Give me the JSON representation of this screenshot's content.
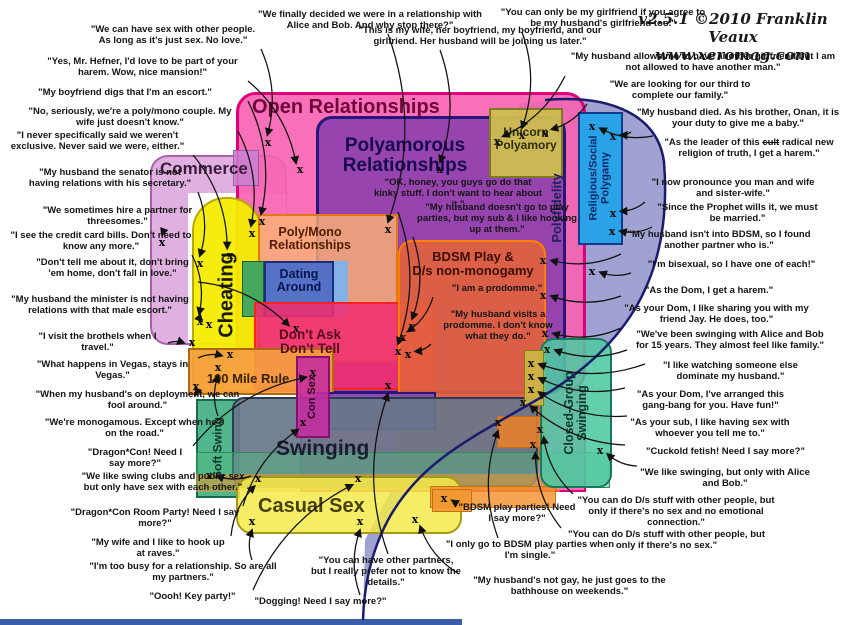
{
  "attribution": {
    "version": "v2.5.1 ©2010 Franklin Veaux",
    "site": "www.xeromag.com"
  },
  "diagram": {
    "blob": {
      "id": "polyfidelity-blob",
      "fill": "rgba(150,153,204,0.9)",
      "stroke": "#1c1c6e"
    },
    "regions": [
      {
        "id": "commerce",
        "x": 150,
        "y": 155,
        "w": 137,
        "h": 190,
        "fill": "rgba(221,170,221,0.92)",
        "stroke": "#a860a8",
        "bw": 2,
        "r": 18,
        "label": "Commerce",
        "lx": 160,
        "ly": 160,
        "fs": 17,
        "lc": "#3a1a3a"
      },
      {
        "id": "commerce-inner",
        "x": 188,
        "y": 193,
        "w": 98,
        "h": 150,
        "fill": "#ffffff"
      },
      {
        "id": "open-relationships",
        "x": 236,
        "y": 92,
        "w": 350,
        "h": 300,
        "fill": "rgba(247,98,176,0.9)",
        "stroke": "#e0007a",
        "bw": 3,
        "r": 20,
        "label": "Open Relationships",
        "lx": 252,
        "ly": 97,
        "fs": 20,
        "lc": "#70043c"
      },
      {
        "id": "open-relationships-lower",
        "x": 300,
        "y": 388,
        "w": 286,
        "h": 104,
        "fill": "rgba(247,98,176,0.9)",
        "stroke": "#e0007a",
        "bw": 2
      },
      {
        "id": "cheating",
        "x": 192,
        "y": 197,
        "w": 70,
        "h": 196,
        "fill": "rgba(244,236,0,0.95)",
        "stroke": "#b8a800",
        "bw": 2,
        "r": "34px 34px 10px 10px",
        "label": "Cheating",
        "vert": true,
        "lx": 227,
        "ly": 295,
        "fs": 20,
        "lc": "#1a1a00"
      },
      {
        "id": "polyamorous-relationships",
        "x": 316,
        "y": 116,
        "w": 250,
        "h": 278,
        "fill": "rgba(138,62,172,0.88)",
        "stroke": "#281578",
        "bw": 3,
        "r": 16,
        "label": "Polyamorous\nRelationships",
        "lx": 325,
        "ly": 136,
        "labelW": 160,
        "fs": 19,
        "lc": "#160a50"
      },
      {
        "id": "unicorn-polyamory",
        "x": 489,
        "y": 108,
        "w": 74,
        "h": 70,
        "fill": "rgba(205,190,80,0.95)",
        "stroke": "#7a7a20",
        "bw": 2,
        "label": "Unicorn\nPolyamory",
        "lx": 489,
        "ly": 126,
        "labelW": 74,
        "fs": 12,
        "lc": "#2e2e08"
      },
      {
        "id": "religious-social-polygamy",
        "x": 578,
        "y": 112,
        "w": 45,
        "h": 133,
        "fill": "#2aa2e8",
        "stroke": "#123a8c",
        "bw": 2,
        "label": "Religious/Social\nPolygamy",
        "vert": true,
        "lx": 600,
        "ly": 178,
        "fs": 11,
        "lc": "#0a2a6a"
      },
      {
        "id": "polyfidelity-label-anchor",
        "x": 0,
        "y": 0,
        "w": 0,
        "h": 0,
        "fill": "transparent",
        "label": "Polyfidelity",
        "vert": true,
        "lx": 557,
        "ly": 208,
        "fs": 13,
        "lc": "#20205a"
      },
      {
        "id": "poly-mono-relationships",
        "x": 258,
        "y": 214,
        "w": 140,
        "h": 148,
        "fill": "rgba(250,178,116,0.82)",
        "stroke": "#e07818",
        "bw": 2,
        "label": "Poly/Mono\nRelationships",
        "lx": 262,
        "ly": 226,
        "labelW": 96,
        "fs": 12.5,
        "lc": "#501c00"
      },
      {
        "id": "dating-around-green",
        "x": 242,
        "y": 261,
        "w": 22,
        "h": 56,
        "fill": "#46a85c",
        "stroke": "#1c5c2c",
        "bw": 1.5
      },
      {
        "id": "dating-around",
        "x": 264,
        "y": 261,
        "w": 70,
        "h": 56,
        "fill": "rgba(70,110,205,0.92)",
        "stroke": "#1c2c80",
        "bw": 2,
        "label": "Dating\nAround",
        "lx": 264,
        "ly": 268,
        "labelW": 70,
        "fs": 12.5,
        "lc": "#0a1650"
      },
      {
        "id": "dating-around-lightblue",
        "x": 334,
        "y": 261,
        "w": 14,
        "h": 56,
        "fill": "rgba(120,180,240,0.9)"
      },
      {
        "id": "dont-ask-dont-tell",
        "x": 254,
        "y": 302,
        "w": 180,
        "h": 88,
        "fill": "rgba(240,45,110,0.88)",
        "stroke": "#ff2020",
        "bw": 2.5,
        "label": "Don't Ask\nDon't Tell",
        "lx": 262,
        "ly": 328,
        "labelW": 96,
        "fs": 13.5,
        "lc": "#58081e"
      },
      {
        "id": "hundred-mile-rule",
        "x": 188,
        "y": 348,
        "w": 146,
        "h": 47,
        "fill": "rgba(245,158,64,0.92)",
        "stroke": "#b06810",
        "bw": 2,
        "label": "100 Mile Rule",
        "lx": 196,
        "ly": 372,
        "labelW": 104,
        "fs": 13,
        "lc": "#3a2000"
      },
      {
        "id": "escort-overlap",
        "x": 233,
        "y": 150,
        "w": 26,
        "h": 36,
        "fill": "rgba(200,130,210,0.85)",
        "stroke": "#9a5aaa",
        "bw": 1.5
      },
      {
        "id": "bdsm-ds-nonmonogamy",
        "x": 398,
        "y": 240,
        "w": 148,
        "h": 226,
        "fill": "rgba(226,99,60,0.9)",
        "stroke": "#ff8000",
        "bw": 2.5,
        "r": 14,
        "label": "BDSM Play &\nD/s non-monogamy",
        "lx": 404,
        "ly": 250,
        "labelW": 138,
        "fs": 13,
        "lc": "#3c0e00"
      },
      {
        "id": "poly-swing-overlap",
        "x": 316,
        "y": 392,
        "w": 120,
        "h": 38,
        "fill": "rgba(110,70,180,0.8)",
        "stroke": "#281578",
        "bw": 2
      },
      {
        "id": "soft-swing",
        "x": 196,
        "y": 399,
        "w": 44,
        "h": 99,
        "fill": "rgba(72,178,136,0.95)",
        "stroke": "#1a6a4a",
        "bw": 2,
        "label": "Soft Swing",
        "vert": true,
        "lx": 218,
        "ly": 448,
        "fs": 12,
        "lc": "#0c3626"
      },
      {
        "id": "swinging",
        "x": 232,
        "y": 397,
        "w": 306,
        "h": 90,
        "fill": "rgba(104,118,138,0.92)",
        "stroke": "#2c3a52",
        "bw": 2,
        "r": 12,
        "label": "Swinging",
        "lx": 276,
        "ly": 438,
        "fs": 21,
        "lc": "#141e2e"
      },
      {
        "id": "con-sex",
        "x": 296,
        "y": 356,
        "w": 34,
        "h": 82,
        "fill": "rgba(198,44,160,0.88)",
        "stroke": "#86106e",
        "bw": 2,
        "label": "Con Sex",
        "vert": true,
        "lx": 313,
        "ly": 397,
        "fs": 11,
        "lc": "#2e0026"
      },
      {
        "id": "swing-green-band",
        "x": 196,
        "y": 452,
        "w": 414,
        "h": 36,
        "fill": "rgba(80,185,125,0.45)",
        "stroke": "#2e8b57",
        "bw": 1.5
      },
      {
        "id": "orange-band",
        "x": 196,
        "y": 474,
        "w": 364,
        "h": 18,
        "fill": "rgba(242,152,50,0.55)"
      },
      {
        "id": "casual-sex",
        "x": 236,
        "y": 476,
        "w": 226,
        "h": 58,
        "fill": "rgba(242,234,74,0.85)",
        "stroke": "#a89a18",
        "bw": 2,
        "r": 16,
        "label": "Casual Sex",
        "lx": 258,
        "ly": 496,
        "fs": 20,
        "lc": "#46400a"
      },
      {
        "id": "bdsm-party-box",
        "x": 497,
        "y": 416,
        "w": 46,
        "h": 32,
        "fill": "rgba(235,130,40,0.85)",
        "stroke": "#c87010",
        "bw": 1.5
      },
      {
        "id": "orange-band-2",
        "x": 430,
        "y": 486,
        "w": 126,
        "h": 22,
        "fill": "rgba(242,142,40,0.8)",
        "stroke": "#c87818",
        "bw": 1.5
      },
      {
        "id": "orange-box-2",
        "x": 432,
        "y": 489,
        "w": 40,
        "h": 23,
        "fill": "rgba(242,152,50,0.9)",
        "stroke": "#c87010",
        "bw": 1.5
      },
      {
        "id": "closed-group-swinging",
        "x": 540,
        "y": 338,
        "w": 72,
        "h": 150,
        "fill": "rgba(78,200,162,0.88)",
        "stroke": "#17785c",
        "bw": 2.5,
        "r": 14,
        "label": "Closed-Group\nSwinging",
        "vert": true,
        "lx": 576,
        "ly": 413,
        "fs": 12.5,
        "lc": "#0a3828"
      },
      {
        "id": "khaki-strip",
        "x": 524,
        "y": 350,
        "w": 20,
        "h": 56,
        "fill": "rgba(205,185,70,0.9)",
        "stroke": "#8a7a10",
        "bw": 1
      },
      {
        "id": "bottom-strip",
        "x": 0,
        "y": 619,
        "w": 462,
        "h": 6,
        "fill": "#3a5da8"
      }
    ]
  },
  "quotes": [
    {
      "id": "q01",
      "t": "\"We can have sex with other people. As long as it's just sex. No love.\"",
      "x": 88,
      "y": 25,
      "w": 170,
      "tx": 268,
      "ty": 143
    },
    {
      "id": "q02",
      "t": "\"Yes, Mr. Hefner, I'd love to be part of your harem. Wow, nice mansion!\"",
      "x": 40,
      "y": 57,
      "w": 205,
      "tx": 300,
      "ty": 170
    },
    {
      "id": "q03",
      "t": "\"My boyfriend digs that I'm an escort.\"",
      "x": 5,
      "y": 88,
      "w": 240,
      "tx": 262,
      "ty": 222
    },
    {
      "id": "q04",
      "t": "\"No, seriously, we're a poly/mono couple. My wife just doesn't know.\"",
      "x": 25,
      "y": 107,
      "w": 210,
      "tx": 252,
      "ty": 234
    },
    {
      "id": "q05",
      "t": "\"I never specifically said we weren't exclusive. Never said we were, either.\"",
      "x": 5,
      "y": 131,
      "w": 185,
      "tx": 230,
      "ty": 256
    },
    {
      "id": "q06",
      "t": "\"My husband the senator is not having relations with his secretary.\"",
      "x": 25,
      "y": 168,
      "w": 170,
      "tx": 200,
      "ty": 264
    },
    {
      "id": "q07",
      "t": "\"We sometimes hire a partner for threesomes.\"",
      "x": 25,
      "y": 206,
      "w": 185,
      "tx": 162,
      "ty": 243
    },
    {
      "id": "q08",
      "t": "\"I see the credit card bills. Don't need to know any more.\"",
      "x": 2,
      "y": 231,
      "w": 198,
      "tx": 200,
      "ty": 322
    },
    {
      "id": "q09",
      "t": "\"Don't tell me about it, don't bring 'em home, don't fall in love.\"",
      "x": 30,
      "y": 258,
      "w": 165,
      "tx": 296,
      "ty": 329
    },
    {
      "id": "q10",
      "t": "\"My husband the minister is not having relations with that male escort.\"",
      "x": 5,
      "y": 295,
      "w": 190,
      "tx": 209,
      "ty": 325
    },
    {
      "id": "q11",
      "t": "\"I visit the brothels when I travel.\"",
      "x": 30,
      "y": 332,
      "w": 135,
      "tx": 192,
      "ty": 343
    },
    {
      "id": "q12",
      "t": "\"What happens in Vegas, stays in Vegas.\"",
      "x": 30,
      "y": 360,
      "w": 165,
      "tx": 230,
      "ty": 355
    },
    {
      "id": "q13",
      "t": "\"When my husband's on deployment, we can fool around.\"",
      "x": 35,
      "y": 390,
      "w": 205,
      "tx": 196,
      "ty": 387
    },
    {
      "id": "q14",
      "t": "\"We're monogamous. Except when he's on the road.\"",
      "x": 42,
      "y": 418,
      "w": 185,
      "tx": 218,
      "ty": 368
    },
    {
      "id": "q15",
      "t": "\"Dragon*Con! Need I say more?\"",
      "x": 80,
      "y": 448,
      "w": 110,
      "tx": 313,
      "ty": 373
    },
    {
      "id": "q16",
      "t": "\"We like swing clubs and public sex but only have sex with each other.\"",
      "x": 78,
      "y": 472,
      "w": 170,
      "tx": 209,
      "ty": 476
    },
    {
      "id": "q17",
      "t": "\"Dragon*Con Room Party! Need I say more?\"",
      "x": 70,
      "y": 508,
      "w": 170,
      "tx": 303,
      "ty": 423
    },
    {
      "id": "q18",
      "t": "\"My wife and I like to hook up at raves.\"",
      "x": 88,
      "y": 538,
      "w": 140,
      "tx": 258,
      "ty": 479
    },
    {
      "id": "q19",
      "t": "\"I'm too busy for a relationship. So are all my partners.\"",
      "x": 88,
      "y": 562,
      "w": 190,
      "tx": 252,
      "ty": 522
    },
    {
      "id": "q20",
      "t": "\"Oooh! Key party!\"",
      "x": 135,
      "y": 592,
      "w": 115,
      "tx": 358,
      "ty": 479
    },
    {
      "id": "q21",
      "t": "\"Dogging! Need I say more?\"",
      "x": 238,
      "y": 597,
      "w": 165,
      "tx": 360,
      "ty": 522
    },
    {
      "id": "q22",
      "t": "\"We finally decided we were in a relationship with Alice and Bob. And why stop there?\"",
      "x": 255,
      "y": 10,
      "w": 230,
      "tx": 388,
      "ty": 230
    },
    {
      "id": "q23",
      "t": "\"This is my wife, her boyfriend, my boyfriend, and our girlfriend. Her husband will be joining us later.\"",
      "x": 350,
      "y": 26,
      "w": 260,
      "tx": 440,
      "ty": 170
    },
    {
      "id": "q24",
      "t": "\"You can only be my girlfriend if you agree to be my husband's girlfriend too.\"",
      "x": 498,
      "y": 8,
      "w": 210,
      "tx": 522,
      "ty": 136
    },
    {
      "id": "q25",
      "t": "\"My husband allows me to have another girlfriend but I am not allowed to have another man.\"",
      "x": 568,
      "y": 52,
      "w": 270,
      "tx": 497,
      "ty": 142
    },
    {
      "id": "q26",
      "t": "\"We are looking for our third to complete our family.\"",
      "x": 590,
      "y": 80,
      "w": 180,
      "tx": 545,
      "ty": 134
    },
    {
      "id": "q27",
      "t": "\"My husband died. As his brother, Onan, it is your duty to give me a baby.\"",
      "x": 634,
      "y": 108,
      "w": 208,
      "tx": 613,
      "ty": 137
    },
    {
      "id": "q28",
      "t": "\"As the leader of this cult radical new religion of truth, I get a harem.\"",
      "strike": "cult",
      "x": 656,
      "y": 138,
      "w": 186,
      "tx": 592,
      "ty": 127
    },
    {
      "id": "q29",
      "t": "\"I now pronounce you man and wife and sister-wife.\"",
      "x": 648,
      "y": 178,
      "w": 170,
      "tx": 613,
      "ty": 214
    },
    {
      "id": "q30",
      "t": "\"Since the Prophet wills it, we must be married.\"",
      "x": 655,
      "y": 203,
      "w": 165,
      "tx": 612,
      "ty": 232
    },
    {
      "id": "q31",
      "t": "\"My husband isn't into BDSM, so I found another partner who is.\"",
      "x": 624,
      "y": 230,
      "w": 190,
      "tx": 543,
      "ty": 261
    },
    {
      "id": "q32",
      "t": "\"I'm bisexual, so I have one of each!\"",
      "x": 634,
      "y": 260,
      "w": 195,
      "tx": 592,
      "ty": 272
    },
    {
      "id": "q33",
      "t": "\"As the Dom, I get a harem.\"",
      "x": 624,
      "y": 286,
      "w": 170,
      "tx": 543,
      "ty": 296
    },
    {
      "id": "q34",
      "t": "\"As your Dom, I like sharing you with my friend Jay. He does, too.\"",
      "x": 624,
      "y": 304,
      "w": 185,
      "tx": 545,
      "ty": 334
    },
    {
      "id": "q35",
      "t": "\"We've been swinging with Alice and Bob for 15 years. They almost feel like family.\"",
      "x": 630,
      "y": 330,
      "w": 200,
      "tx": 547,
      "ty": 350
    },
    {
      "id": "q36",
      "t": "\"I like watching someone else dominate my husband.\"",
      "x": 648,
      "y": 361,
      "w": 165,
      "tx": 531,
      "ty": 364
    },
    {
      "id": "q37",
      "t": "\"As your Dom, I've arranged this gang-bang for you. Have fun!\"",
      "x": 628,
      "y": 390,
      "w": 165,
      "tx": 531,
      "ty": 377
    },
    {
      "id": "q38",
      "t": "\"As your sub, I like having sex with whoever you tell me to.\"",
      "x": 630,
      "y": 418,
      "w": 160,
      "tx": 531,
      "ty": 390
    },
    {
      "id": "q39",
      "t": "\"Cuckold fetish! Need I say more?\"",
      "x": 628,
      "y": 447,
      "w": 195,
      "tx": 523,
      "ty": 403
    },
    {
      "id": "q40",
      "t": "\"We like swinging, but only with Alice and Bob.\"",
      "x": 640,
      "y": 468,
      "w": 170,
      "tx": 600,
      "ty": 451
    },
    {
      "id": "q41",
      "t": "\"You can do D/s stuff with other people, but only if there's no sex and no emotional connection.\"",
      "x": 576,
      "y": 496,
      "w": 200,
      "tx": 540,
      "ty": 430
    },
    {
      "id": "q42",
      "t": "\"You can do D/s stuff with other people, but only if there's no sex.\"",
      "x": 564,
      "y": 530,
      "w": 205,
      "tx": 533,
      "ty": 445
    },
    {
      "id": "q43",
      "t": "\"My husband's not gay, he just goes to the bathhouse on weekends.\"",
      "x": 462,
      "y": 576,
      "w": 215,
      "tx": 415,
      "ty": 520
    },
    {
      "id": "q44",
      "t": "\"OK, honey, you guys go do that kinky stuff. I don't want to hear about it.\"",
      "x": 372,
      "y": 178,
      "w": 172,
      "tx": 398,
      "ty": 352
    },
    {
      "id": "q45",
      "t": "\"My husband doesn't go to play parties, but my sub & I like hooking up at them.\"",
      "x": 416,
      "y": 203,
      "w": 162,
      "tx": 412,
      "ty": 327
    },
    {
      "id": "q46",
      "t": "\"I am a prodomme.\"",
      "x": 436,
      "y": 284,
      "w": 122,
      "tx": 403,
      "ty": 338
    },
    {
      "id": "q47",
      "t": "\"My husband visits a prodomme. I don't know what they do.\"",
      "x": 434,
      "y": 310,
      "w": 128,
      "tx": 408,
      "ty": 355
    },
    {
      "id": "q48",
      "t": "\"You can have other partners, but I really prefer not to know the details.\"",
      "x": 310,
      "y": 556,
      "w": 152,
      "tx": 388,
      "ty": 386
    },
    {
      "id": "q49",
      "t": "\"BDSM play parties! Need I say more?\"",
      "x": 458,
      "y": 503,
      "w": 118,
      "tx": 444,
      "ty": 499
    },
    {
      "id": "q50",
      "t": "\"I only go to BDSM play parties when I'm single.\"",
      "x": 444,
      "y": 540,
      "w": 172,
      "tx": 498,
      "ty": 423
    }
  ]
}
